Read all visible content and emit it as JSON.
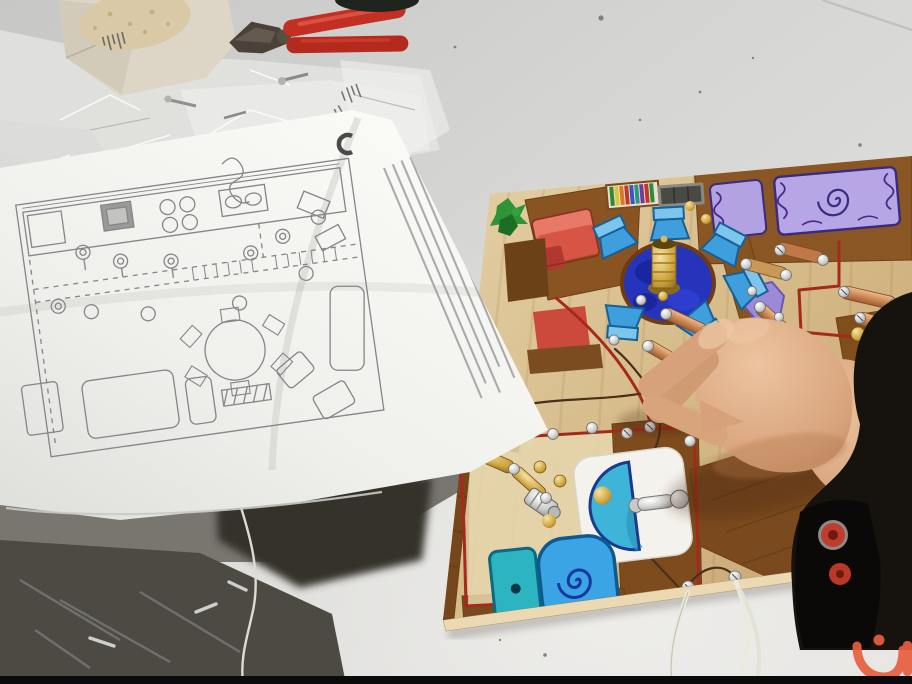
{
  "scene": {
    "type": "photograph",
    "setting": "white workshop table in a classroom, electronics craft session",
    "description": "A paper sheet with a hand-drawn apartment floor plan lies next to a plywood school project board painted as a house floor plan with drawn furniture and real electrical contacts, screws and wires; a hand reaches in from the right placing a wire; pliers and plastic bags with hardware lie at the top of the table."
  },
  "objects": {
    "tools": {
      "pliers": "combination pliers with red handles, jaws pointing left",
      "black_tool": "dark tool handle cut off at top edge"
    },
    "packaging": {
      "cardboard_box": "crumpled cream cardboard box piece with tiny printed label",
      "plastic_bags": "translucent plastic bags with small screws inside",
      "dark_bag": "dark plastic bag with metal parts, bottom-left corner"
    },
    "instruction_sheet": {
      "content": "hand-drawn apartment floor plan: kitchen counter with stove burners and sink, dashed corridor walls, lamp node circles, round dining table with chairs, sofas, TV cabinet, beds",
      "text_block": "column of small printed instruction text (illegible)",
      "mark": "bold dark C-shaped mark near top edge"
    },
    "project_board": {
      "material": "plywood painted tan with brown walls",
      "theme": "house floor plan wired as an electric circuit",
      "rooms": [
        "living room",
        "dining area",
        "bedroom",
        "bathroom"
      ],
      "drawn_furniture": [
        "green plant",
        "red sofa",
        "dark side table",
        "rainbow bookshelf",
        "gray TV",
        "round blue dining table",
        "light blue chairs",
        "bed with lilac bedding and swirl blanket",
        "purple rug",
        "white sink with teal basin",
        "teal and blue toilet with spiral lid"
      ],
      "electrics": [
        "brass lamp holder on table",
        "copper contact strips",
        "silver screws",
        "brass paper fasteners",
        "red insulated wire outlining rooms",
        "bare copper wires",
        "metal faucet piece on sink",
        "metal cylinder component",
        "two white lead wires hanging off bottom edge"
      ]
    },
    "person": {
      "hand": "right hand pinching a bare wire over the board",
      "sleeve": "dark jacket sleeve with black cuff",
      "cuff_buttons": 2
    },
    "watermark": {
      "glyph": "orange Arabic letter noon with dot and bar",
      "position": "bottom-right corner"
    }
  },
  "palette": {
    "table_gray": "#d9d9d7",
    "paper_white": "#f7f7f4",
    "plan_ink": "#85858a",
    "board_wood": "#d9c194",
    "wall_brown": "#8a5724",
    "sofa_red": "#d85444",
    "table_blue": "#2634bc",
    "chair_blue": "#3f9fdc",
    "bed_lilac": "#b6a6e6",
    "rug_purple": "#9a8ad8",
    "plant_green": "#2f9438",
    "toilet_teal": "#2db4c2",
    "bowl_blue": "#3aa4e4",
    "basin_teal": "#3db4d8",
    "wire_red": "#a62a1c",
    "copper": "#c07848",
    "brass": "#c8a030",
    "pliers_red": "#c23024",
    "skin": "#d7a27b",
    "sleeve_black": "#16120e",
    "button_red": "#c03c2c",
    "watermark_orange": "#e85f3e",
    "shadow_dark": "#35322c"
  }
}
